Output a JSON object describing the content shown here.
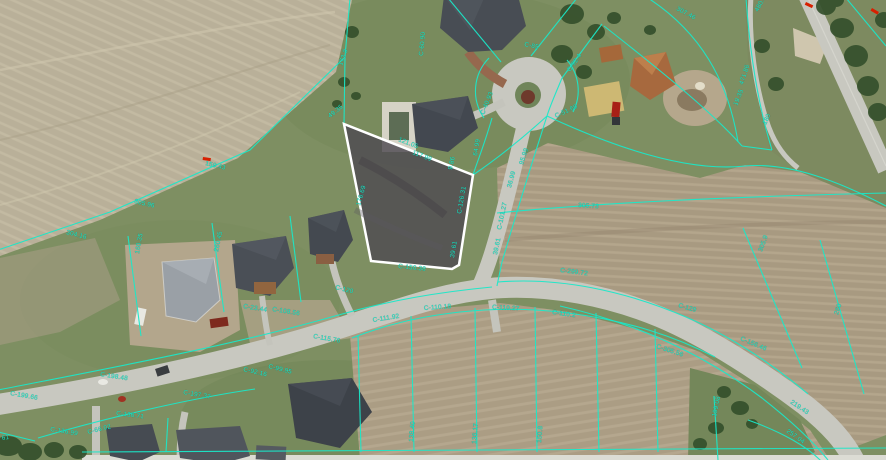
{
  "map": {
    "line_color": "#1ae8c8",
    "label_color": "#17e9c9",
    "annotation_color": "#d81f00",
    "highlight": {
      "stroke_color": "#ffffff",
      "fill_color": "#4e4a52"
    },
    "labels": [
      {
        "text": "173.3",
        "x": 342,
        "y": 66,
        "rot": -70
      },
      {
        "text": "49.35",
        "x": 330,
        "y": 118,
        "rot": -38
      },
      {
        "text": "121.05",
        "x": 398,
        "y": 141,
        "rot": 21
      },
      {
        "text": "117.99",
        "x": 412,
        "y": 154,
        "rot": 21
      },
      {
        "text": "9.86",
        "x": 452,
        "y": 170,
        "rot": -78
      },
      {
        "text": "C-126.31",
        "x": 461,
        "y": 214,
        "rot": -80
      },
      {
        "text": "39.61",
        "x": 454,
        "y": 258,
        "rot": -80
      },
      {
        "text": "C-150.38",
        "x": 398,
        "y": 268,
        "rot": 6
      },
      {
        "text": "176.69",
        "x": 360,
        "y": 206,
        "rot": -74
      },
      {
        "text": "C-60.90",
        "x": 423,
        "y": 56,
        "rot": -85
      },
      {
        "text": "C-85",
        "x": 524,
        "y": 46,
        "rot": 12
      },
      {
        "text": "C-92.4",
        "x": 570,
        "y": 72,
        "rot": -55
      },
      {
        "text": "C-40.93",
        "x": 484,
        "y": 115,
        "rot": -68
      },
      {
        "text": "C-51.69",
        "x": 556,
        "y": 118,
        "rot": -25
      },
      {
        "text": "64.99",
        "x": 477,
        "y": 156,
        "rot": -80
      },
      {
        "text": "95.99",
        "x": 523,
        "y": 165,
        "rot": -72
      },
      {
        "text": "36.99",
        "x": 511,
        "y": 188,
        "rot": -75
      },
      {
        "text": "C-101.27",
        "x": 501,
        "y": 230,
        "rot": -78
      },
      {
        "text": "39.61",
        "x": 497,
        "y": 255,
        "rot": -78
      },
      {
        "text": "305.73",
        "x": 578,
        "y": 207,
        "rot": 4
      },
      {
        "text": "C-299.72",
        "x": 560,
        "y": 272,
        "rot": 7
      },
      {
        "text": "307.46",
        "x": 676,
        "y": 10,
        "rot": 28
      },
      {
        "text": "19.35",
        "x": 737,
        "y": 106,
        "rot": -68
      },
      {
        "text": "480.1",
        "x": 758,
        "y": 12,
        "rot": -62
      },
      {
        "text": "471.86",
        "x": 743,
        "y": 85,
        "rot": -72
      },
      {
        "text": "180",
        "x": 766,
        "y": 125,
        "rot": -65
      },
      {
        "text": "159.43",
        "x": 205,
        "y": 165,
        "rot": 13
      },
      {
        "text": "305.96",
        "x": 134,
        "y": 203,
        "rot": 13
      },
      {
        "text": "304.16",
        "x": 66,
        "y": 234,
        "rot": 14
      },
      {
        "text": "260.45",
        "x": 218,
        "y": 252,
        "rot": -78
      },
      {
        "text": "160.35",
        "x": 139,
        "y": 254,
        "rot": -80
      },
      {
        "text": "C-23.44",
        "x": 243,
        "y": 308,
        "rot": 9
      },
      {
        "text": "C-108.56",
        "x": 272,
        "y": 311,
        "rot": 9
      },
      {
        "text": "C-120",
        "x": 335,
        "y": 289,
        "rot": 14
      },
      {
        "text": "C-115.76",
        "x": 313,
        "y": 338,
        "rot": 10
      },
      {
        "text": "C-199.66",
        "x": 10,
        "y": 395,
        "rot": 10
      },
      {
        "text": "C-198.48",
        "x": 100,
        "y": 376,
        "rot": 9
      },
      {
        "text": "C-197.37",
        "x": 183,
        "y": 394,
        "rot": 10
      },
      {
        "text": "C-92.16",
        "x": 243,
        "y": 371,
        "rot": 13
      },
      {
        "text": "C-99.95",
        "x": 268,
        "y": 368,
        "rot": 14
      },
      {
        "text": "C-136.71",
        "x": 116,
        "y": 415,
        "rot": 7
      },
      {
        "text": "C-136.99",
        "x": 50,
        "y": 431,
        "rot": 9
      },
      {
        "text": "61",
        "x": 2,
        "y": 440,
        "rot": -8
      },
      {
        "text": "C-66.02",
        "x": 88,
        "y": 434,
        "rot": -14
      },
      {
        "text": "C-111.92",
        "x": 373,
        "y": 322,
        "rot": -9
      },
      {
        "text": "C-110.18",
        "x": 424,
        "y": 310,
        "rot": -4
      },
      {
        "text": "C-110.27",
        "x": 492,
        "y": 309,
        "rot": 3
      },
      {
        "text": "C-110.2",
        "x": 552,
        "y": 314,
        "rot": 8
      },
      {
        "text": "C-129",
        "x": 678,
        "y": 307,
        "rot": 16
      },
      {
        "text": "C-305.56",
        "x": 656,
        "y": 348,
        "rot": 18
      },
      {
        "text": "C-156.46",
        "x": 740,
        "y": 340,
        "rot": 23
      },
      {
        "text": "305.9",
        "x": 762,
        "y": 252,
        "rot": -70
      },
      {
        "text": "260",
        "x": 838,
        "y": 315,
        "rot": -72
      },
      {
        "text": "219.43",
        "x": 790,
        "y": 403,
        "rot": 34
      },
      {
        "text": "257.04",
        "x": 786,
        "y": 432,
        "rot": 35
      },
      {
        "text": "199.08",
        "x": 716,
        "y": 417,
        "rot": -78
      },
      {
        "text": "138.40",
        "x": 413,
        "y": 442,
        "rot": -85
      },
      {
        "text": "136.17",
        "x": 476,
        "y": 444,
        "rot": -85
      },
      {
        "text": "150.8",
        "x": 541,
        "y": 443,
        "rot": -85
      }
    ],
    "red_marks": [
      {
        "x": 806,
        "y": 2,
        "rot": 25
      },
      {
        "x": 872,
        "y": 8,
        "rot": 30
      },
      {
        "x": 203,
        "y": 157,
        "rot": 8
      }
    ]
  }
}
